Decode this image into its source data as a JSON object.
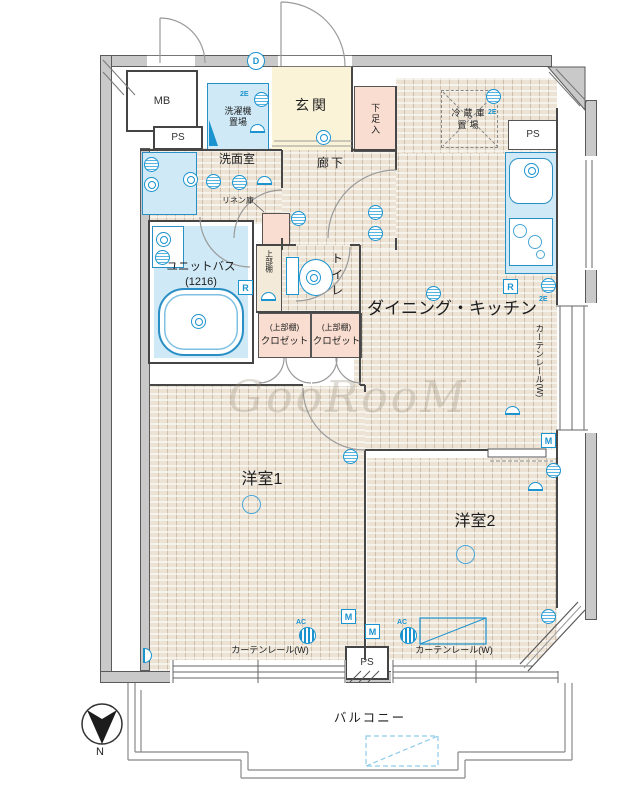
{
  "watermark": "GooRooM",
  "compass": {
    "north": "N"
  },
  "labels": {
    "mb": "MB",
    "ps": "PS",
    "entrance": "玄関",
    "shoe_box": "下足入",
    "washer_line1": "洗濯機",
    "washer_line2": "置場",
    "washroom": "洗面室",
    "hallway": "廊下",
    "linen": "リネン庫",
    "bath_name": "ユニットバス",
    "bath_size": "(1216)",
    "upper_shelf": "上部棚",
    "toilet": "トイレ",
    "closet_upper": "(上部棚)",
    "closet": "クロゼット",
    "fridge_line1": "冷蔵庫",
    "fridge_line2": "置場",
    "dining_kitchen": "ダイニング・キッチン",
    "room1": "洋室1",
    "room2": "洋室2",
    "balcony": "バルコニー",
    "curtain_rail": "カーテンレール(W)"
  },
  "badges": {
    "d": "D",
    "r": "R",
    "m": "M",
    "ac": "AC",
    "e2": "2E"
  },
  "colors": {
    "wall": "#c9c9c9",
    "floor": "#ece3d5",
    "wet_area": "#cfe9f6",
    "entrance": "#faf3d8",
    "storage": "#f8ddd0",
    "symbol_blue": "#1b93cf"
  }
}
